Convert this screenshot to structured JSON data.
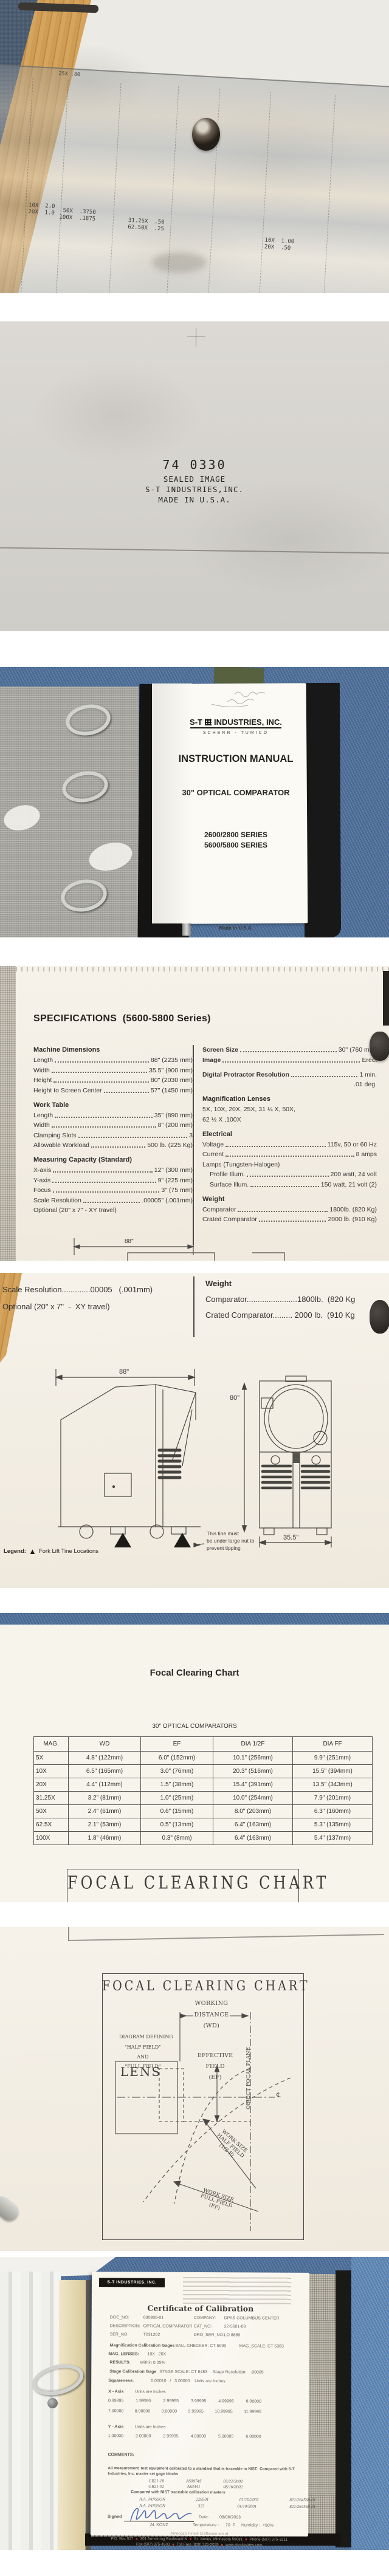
{
  "colors": {
    "denim": "#4d6f99",
    "paper": "#f4efe6",
    "signature_blue": "#3a56a8",
    "carpet": "#46566b",
    "wood": "#c99450"
  },
  "photo1": {
    "mag_top": "25X .80",
    "labels": [
      "10X  2.0\n20X  1.0",
      "  50X  .3750\n 100X  .1875",
      "31.25X  .50\n62.50X  .25",
      "10X  1.00\n20X  .50"
    ]
  },
  "photo2": {
    "part_number": "74 0330",
    "line1": "SEALED IMAGE",
    "line2": "S-T INDUSTRIES,INC.",
    "line3": "MADE IN U.S.A."
  },
  "cover": {
    "brand_st": "S-T",
    "brand_rest": "INDUSTRIES, INC.",
    "brand_sub": "SCHERR - TUMICO",
    "title": "INSTRUCTION MANUAL",
    "product": "30\" OPTICAL COMPARATOR",
    "series1": "2600/2800 SERIES",
    "series2": "5600/5800 SERIES",
    "made": "Made in U.S.A."
  },
  "specs": {
    "title": "SPECIFICATIONS  (5600-5800 Series)",
    "md_title": "Machine Dimensions",
    "md": [
      {
        "l": "Length",
        "v": "88\"  (2235 mm)"
      },
      {
        "l": "Width",
        "v": "35.5\" (900 mm)"
      },
      {
        "l": "Height",
        "v": "80\"  (2030 mm)"
      },
      {
        "l": "Height to Screen Center",
        "v": "57\"  (1450 mm)"
      }
    ],
    "wt_title": "Work Table",
    "wt": [
      {
        "l": "Length",
        "v": "35\"  (890 mm)"
      },
      {
        "l": "Width",
        "v": "8\"  (200 mm)"
      },
      {
        "l": "Clamping Slots",
        "v": "3"
      },
      {
        "l": "Allowable Workload",
        "v": "500 lb.  (225 Kg)"
      }
    ],
    "mc_title": "Measuring Capacity (Standard)",
    "mc": [
      {
        "l": "X-axis",
        "v": "12\"  (300 mm)"
      },
      {
        "l": "Y-axis",
        "v": "9\"  (225 mm)"
      },
      {
        "l": "Focus",
        "v": "3\"   (75 mm)"
      },
      {
        "l": "Scale Resolution",
        "v": ".00005\"  (.001mm)"
      }
    ],
    "mc_note": "Optional (20\" x 7\"  -  XY travel)",
    "screen": [
      {
        "l": "Screen Size",
        "v": "30\"  (760 mm)"
      },
      {
        "l": "Image",
        "v": "Erect"
      }
    ],
    "dpr_label": "Digital Protractor Resolution",
    "dpr_v1": "1 min.",
    "dpr_v2": ".01 deg.",
    "ml_title": "Magnification Lenses",
    "ml_line1": "5X, 10X, 20X, 25X, 31 ¼ X, 50X,",
    "ml_line2": "62 ½ X ,100X",
    "el_title": "Electrical",
    "el": [
      {
        "l": "Voltage",
        "v": "115v, 50 or 60 Hz"
      },
      {
        "l": "Current",
        "v": "8 amps"
      }
    ],
    "lamps": "Lamps  (Tungsten-Halogen)",
    "lamp_rows": [
      {
        "l": "Profile Illum.",
        "v": "200 watt, 24 volt"
      },
      {
        "l": "Surface Illum.",
        "v": "150 watt, 21 volt  (2)"
      }
    ],
    "w_title": "Weight",
    "w": [
      {
        "l": "Comparator",
        "v": "1800lb.  (820 Kg)"
      },
      {
        "l": "Crated Comparator",
        "v": "2000 lb.  (910 Kg)"
      }
    ]
  },
  "photo5": {
    "left1": "Scale Resolution.............00005   (.001mm)",
    "left2": "Optional (20\" x 7\"  -  XY travel)",
    "right1": "Weight",
    "right2": "Comparator.......................1800lb.  (820 Kg",
    "right3": "Crated Comparator......... 2000 lb.  (910 Kg",
    "dim_w": "88\"",
    "dim_h": "80\"",
    "dim_d": "35.5\"",
    "note1": "This tine must",
    "note2": "be under large nut to",
    "note3": "prevent tipping",
    "legend_label": "Legend:",
    "legend_text": "Fork Lift Tine Locations",
    "legend_icon": "▲"
  },
  "focal": {
    "page_title": "Focal Clearing Chart",
    "table_title": "30\" OPTICAL COMPARATORS",
    "headers": [
      "MAG.",
      "WD",
      "EF",
      "DIA 1/2F",
      "DIA FF"
    ],
    "rows": [
      [
        "5X",
        "4.8\"  (122mm)",
        "6.0\"  (152mm)",
        "10.1\"  (256mm)",
        "9.9\"  (251mm)"
      ],
      [
        "10X",
        "6.5\"  (165mm)",
        "3.0\"  (76mm)",
        "20.3\"  (516mm)",
        "15.5\"  (394mm)"
      ],
      [
        "20X",
        "4.4\"  (112mm)",
        "1.5\"  (38mm)",
        "15.4\"  (391mm)",
        "13.5\"  (343mm)"
      ],
      [
        "31.25X",
        "3.2\"  (81mm)",
        "1.0\"  (25mm)",
        "10.0\"  (254mm)",
        "7.9\"  (201mm)"
      ],
      [
        "50X",
        "2.4\"  (61mm)",
        "0.6\"  (15mm)",
        "8.0\"  (203mm)",
        "6.3\"  (160mm)"
      ],
      [
        "62.5X",
        "2.1\"  (53mm)",
        "0.5\"  (13mm)",
        "6.4\"  (163mm)",
        "5.3\"  (135mm)"
      ],
      [
        "100X",
        "1.8\"  (46mm)",
        "0.3\"  (8mm)",
        "6.4\"  (163mm)",
        "5.4\"  (137mm)"
      ]
    ],
    "banner": "FOCAL CLEARING CHART"
  },
  "diagram": {
    "title": "FOCAL CLEARING CHART",
    "wd1": "WORKING",
    "wd2": "DISTANCE",
    "wd3": "(WD)",
    "ef1": "EFFECTIVE",
    "ef2": "FIELD",
    "ef3": "(EF)",
    "def1": "DIAGRAM DEFINING",
    "def2": "\"HALF FIELD\"",
    "def3": "AND",
    "def4": "\"FULL FIELD\"",
    "ofp": "OBJECT FOCAL PLANE",
    "lens": "LENS",
    "cl": "℄",
    "hf1": "WORK SIZE",
    "hf2": "HALF FIELD",
    "hf3": "(1/2 F)",
    "ff1": "WORK SIZE",
    "ff2": "FULL FIELD",
    "ff3": "(FF)"
  },
  "certificate": {
    "logo": "S-T INDUSTRIES, INC.",
    "title": "Certificate of Calibration",
    "doc_no_label": "DOC_NO:",
    "doc_no": "030806-01",
    "company_label": "COMPANY:",
    "company": "DPAS COLUMBUS CENTER",
    "description_label": "DESCRIPTION:",
    "description": "OPTICAL COMPARATOR",
    "cat_no_label": "CAT_NO:",
    "cat_no": "22-5601-03",
    "ser_no_label": "SER_NO:",
    "ser_no": "T031202",
    "dro_label": "DRO_SER_NO:",
    "dro": "LO 8889",
    "mag_gages_label": "Magnification Calibration Gages",
    "ball_checker": "BALL CHECKER: CT 5999",
    "mag_scale": "MAG_SCALE: CT 5383",
    "mag_lenses_label": "MAG_LENSES:",
    "mag_lenses": "10X   20X",
    "results_label": "RESULTS:",
    "results": "Within 0.05%",
    "stage_gage_label": "Stage Calibration Gage",
    "stage_scale": "STAGE SCALE: CT 8483",
    "stage_res_label": "Stage Resolution:",
    "stage_res": ".00005",
    "squareness_label": "Squareness:",
    "squareness": "0.00010   /   3.00000    Units are Inches",
    "x_axis_label": "X - Axis",
    "units_label": "Units are Inches",
    "x_rows": [
      [
        "0.99995",
        "1.99995",
        "2.99995",
        "3.99995",
        "4.99995",
        "6.00000"
      ],
      [
        "7.00000",
        "8.00000",
        "9.00000",
        "9.99995",
        "10.99995",
        "11.99995"
      ]
    ],
    "y_axis_label": "Y - Axis",
    "y_rows": [
      [
        "1.00000",
        "2.00000",
        "2.99995",
        "4.00000",
        "5.00005",
        "6.00000"
      ]
    ],
    "comments_label": "COMMENTS:",
    "nist_note_1": "All measurement  test equipment calibrated to a standard that is traceable to NIST.  Compared with S-T",
    "nist_note_2": "Industries, Inc. master set gage blocks",
    "gage_rows": [
      [
        "GB21-10",
        "AS0974S",
        "03/22/2002"
      ],
      [
        "GB21-02",
        "AS3441",
        "08/16/2002"
      ]
    ],
    "compared_note": "Compared with NIST traceable calibration masters",
    "master_rows": [
      [
        "A.A. JANSSON",
        "228501",
        "01/10/2001",
        "821/264568-01"
      ],
      [
        "A.A. JANSSON",
        "323",
        "01/10/2001",
        "821/264568-01"
      ]
    ],
    "signed_label": "Signed",
    "signed_name": "AL KONZ",
    "date_label": "Date:",
    "date": "08/06/2003",
    "temp_label": "Temperature :",
    "temp": "70  F",
    "humidity_label": "Humidity :  <50%",
    "footer1": "America's Finest Craftsmen are at",
    "footer2": [
      "P.O. Box 517",
      "301 Armstrong Boulevard N",
      "St. James, Minnesota 56081",
      "Phone (507) 375-3211"
    ],
    "footer3": [
      "Fax (507) 375-4503",
      "Toll Free (800) 326-2039",
      "www.stindustries.com"
    ],
    "bullet": "■"
  }
}
